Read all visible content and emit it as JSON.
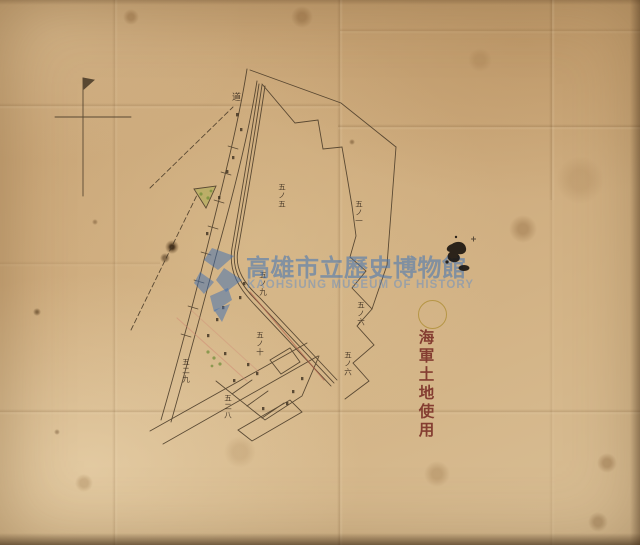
{
  "watermark": {
    "title_cjk": "高雄市立歷史博物館",
    "title_en": "KAOHSIUNG MUSEUM OF HISTORY",
    "color": "#3e73b6"
  },
  "annotations": {
    "seal_text": "海軍土地使用",
    "seal_color": "#7c3128",
    "circle_stamp_color": "#ac8c30"
  },
  "map": {
    "ink_color": "#4a3b28",
    "road_label": "道",
    "labels": [
      {
        "text": "道",
        "x": 231,
        "y": 92,
        "size": 9
      },
      {
        "text": "五ノ五",
        "x": 278,
        "y": 183,
        "size": 7.5
      },
      {
        "text": "五ノ一",
        "x": 355,
        "y": 200,
        "size": 7.5
      },
      {
        "text": "五ノ九",
        "x": 259,
        "y": 271,
        "size": 7.5
      },
      {
        "text": "五ノ十",
        "x": 256,
        "y": 331,
        "size": 7.5
      },
      {
        "text": "五ノ六",
        "x": 357,
        "y": 301,
        "size": 7.5
      },
      {
        "text": "五ノ六",
        "x": 344,
        "y": 351,
        "size": 7.5
      },
      {
        "text": "五二九",
        "x": 182,
        "y": 358,
        "size": 7.5
      },
      {
        "text": "五二八",
        "x": 224,
        "y": 394,
        "size": 7.5
      }
    ]
  }
}
